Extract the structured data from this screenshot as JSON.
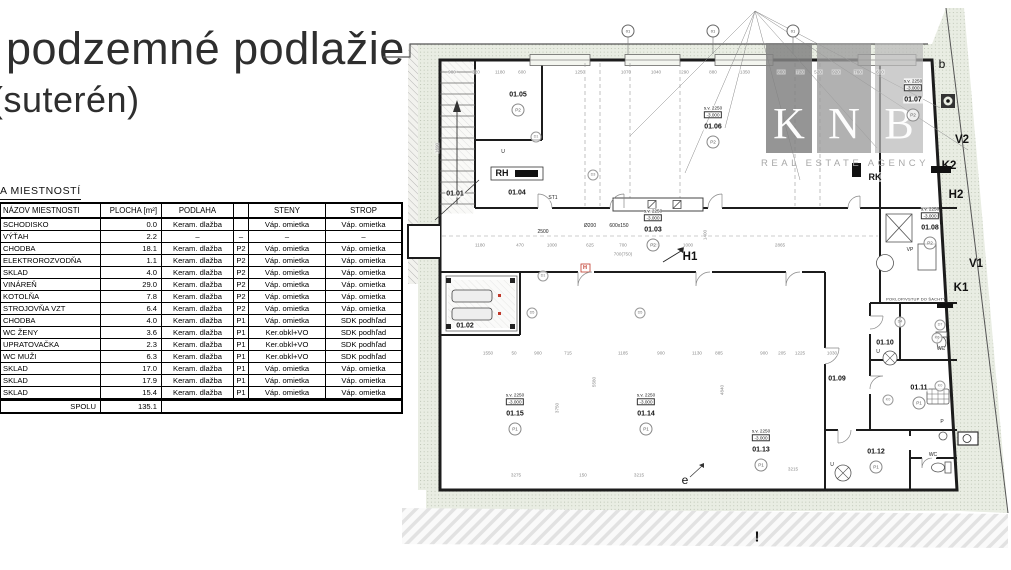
{
  "title": {
    "line1": "podzemné podlažie",
    "line2": "(suterén)"
  },
  "legend": {
    "heading": "A MIESTNOSTÍ",
    "columns": [
      "NÁZOV MIESTNOSTI",
      "PLOCHA [m²]",
      "PODLAHA",
      "",
      "STENY",
      "STROP"
    ],
    "rows": [
      [
        "SCHODISKO",
        "0.0",
        "Keram. dlažba",
        "",
        "Váp. omietka",
        "Váp. omietka"
      ],
      [
        "VÝŤAH",
        "2.2",
        "–",
        "–",
        "–",
        "–"
      ],
      [
        "CHODBA",
        "18.1",
        "Keram. dlažba",
        "P2",
        "Váp. omietka",
        "Váp. omietka"
      ],
      [
        "ELEKTROROZVODŇA",
        "1.1",
        "Keram. dlažba",
        "P2",
        "Váp. omietka",
        "Váp. omietka"
      ],
      [
        "SKLAD",
        "4.0",
        "Keram. dlažba",
        "P2",
        "Váp. omietka",
        "Váp. omietka"
      ],
      [
        "VINÁREŇ",
        "29.0",
        "Keram. dlažba",
        "P2",
        "Váp. omietka",
        "Váp. omietka"
      ],
      [
        "KOTOLŇA",
        "7.8",
        "Keram. dlažba",
        "P2",
        "Váp. omietka",
        "Váp. omietka"
      ],
      [
        "STROJOVŇA VZT",
        "6.4",
        "Keram. dlažba",
        "P2",
        "Váp. omietka",
        "Váp. omietka"
      ],
      [
        "CHODBA",
        "4.0",
        "Keram. dlažba",
        "P1",
        "Váp. omietka",
        "SDK podhľad"
      ],
      [
        "WC ŽENY",
        "3.6",
        "Keram. dlažba",
        "P1",
        "Ker.obkl+VO",
        "SDK podhľad"
      ],
      [
        "UPRATOVAČKA",
        "2.3",
        "Keram. dlažba",
        "P1",
        "Ker.obkl+VO",
        "SDK podhľad"
      ],
      [
        "WC MUŽI",
        "6.3",
        "Keram. dlažba",
        "P1",
        "Ker.obkl+VO",
        "SDK podhľad"
      ],
      [
        "SKLAD",
        "17.0",
        "Keram. dlažba",
        "P1",
        "Váp. omietka",
        "Váp. omietka"
      ],
      [
        "SKLAD",
        "17.9",
        "Keram. dlažba",
        "P1",
        "Váp. omietka",
        "Váp. omietka"
      ],
      [
        "SKLAD",
        "15.4",
        "Keram. dlažba",
        "P1",
        "Váp. omietka",
        "Váp. omietka"
      ]
    ],
    "total_label": "SPOLU",
    "total_value": "135.1"
  },
  "watermark": {
    "letters": [
      "K",
      "N",
      "B"
    ],
    "subtitle": "REAL ESTATE AGENCY",
    "colors": [
      "#828282",
      "#9e9e9e",
      "#bababa"
    ]
  },
  "colors": {
    "accent_red": "#c0392b",
    "site_band": "#e9ede3",
    "wall": "#1c1c1c"
  },
  "plan": {
    "elevation": {
      "height": "s.v. 2250",
      "level": "-3.000"
    },
    "rooms": [
      {
        "id": "01.01",
        "x": 75,
        "y": 186,
        "elev": false,
        "badge": ""
      },
      {
        "id": "01.02",
        "x": 85,
        "y": 318,
        "elev": false,
        "badge": ""
      },
      {
        "id": "01.03",
        "x": 273,
        "y": 222,
        "elev": true,
        "badge": "P2"
      },
      {
        "id": "01.04",
        "x": 137,
        "y": 185,
        "elev": false,
        "badge": ""
      },
      {
        "id": "01.05",
        "x": 138,
        "y": 87,
        "elev": false,
        "badge": "P2"
      },
      {
        "id": "01.06",
        "x": 333,
        "y": 119,
        "elev": true,
        "badge": "P2"
      },
      {
        "id": "01.07",
        "x": 533,
        "y": 92,
        "elev": true,
        "badge": "P2"
      },
      {
        "id": "01.08",
        "x": 550,
        "y": 220,
        "elev": true,
        "badge": "P2"
      },
      {
        "id": "01.09",
        "x": 457,
        "y": 371,
        "elev": false,
        "badge": ""
      },
      {
        "id": "01.10",
        "x": 505,
        "y": 335,
        "elev": false,
        "badge": ""
      },
      {
        "id": "01.11",
        "x": 539,
        "y": 380,
        "elev": false,
        "badge": "P1"
      },
      {
        "id": "01.12",
        "x": 496,
        "y": 444,
        "elev": false,
        "badge": "P1"
      },
      {
        "id": "01.13",
        "x": 381,
        "y": 442,
        "elev": true,
        "badge": "P1"
      },
      {
        "id": "01.14",
        "x": 266,
        "y": 406,
        "elev": true,
        "badge": "P1"
      },
      {
        "id": "01.15",
        "x": 135,
        "y": 406,
        "elev": true,
        "badge": "P1"
      }
    ],
    "markers": [
      {
        "t": "H1",
        "x": 310,
        "y": 249,
        "c": "lg"
      },
      {
        "t": "H2",
        "x": 576,
        "y": 187,
        "c": "lg"
      },
      {
        "t": "K2",
        "x": 569,
        "y": 158,
        "c": "lg"
      },
      {
        "t": "V2",
        "x": 582,
        "y": 132,
        "c": "lg"
      },
      {
        "t": "V1",
        "x": 596,
        "y": 256,
        "c": "lg"
      },
      {
        "t": "K1",
        "x": 581,
        "y": 280,
        "c": "lg"
      },
      {
        "t": "b",
        "x": 562,
        "y": 56,
        "c": "plain"
      },
      {
        "t": "e",
        "x": 305,
        "y": 472,
        "c": "plain"
      },
      {
        "t": "!",
        "x": 377,
        "y": 529,
        "c": "excl"
      },
      {
        "t": "RK",
        "x": 495,
        "y": 169,
        "c": "md"
      },
      {
        "t": "RH",
        "x": 122,
        "y": 165,
        "c": "md"
      },
      {
        "t": "WC",
        "x": 561,
        "y": 341,
        "c": "tiny"
      },
      {
        "t": "WC",
        "x": 553,
        "y": 447,
        "c": "tiny"
      },
      {
        "t": "P",
        "x": 562,
        "y": 414,
        "c": "tiny"
      },
      {
        "t": "U",
        "x": 498,
        "y": 344,
        "c": "tiny"
      },
      {
        "t": "U",
        "x": 452,
        "y": 457,
        "c": "tiny"
      },
      {
        "t": "U",
        "x": 123,
        "y": 144,
        "c": "tiny"
      },
      {
        "t": "VP",
        "x": 530,
        "y": 242,
        "c": "tiny"
      },
      {
        "t": "ST1",
        "x": 173,
        "y": 190,
        "c": "tiny"
      },
      {
        "t": "Ø200",
        "x": 210,
        "y": 218,
        "c": "tiny"
      },
      {
        "t": "600x150",
        "x": 239,
        "y": 218,
        "c": "tiny"
      },
      {
        "t": "2500",
        "x": 163,
        "y": 224,
        "c": "tiny"
      },
      {
        "t": "H",
        "x": 205,
        "y": 260,
        "c": "red"
      },
      {
        "t": "POKLOP/VSTUP DO ŠACHTY",
        "x": 536,
        "y": 291,
        "c": "micro"
      }
    ],
    "grid_markers": [
      {
        "label": "01",
        "x": 248,
        "y": 23
      },
      {
        "label": "01",
        "x": 333,
        "y": 23
      },
      {
        "label": "01",
        "x": 413,
        "y": 23
      }
    ],
    "tags": [
      {
        "t": "D1",
        "x": 156,
        "y": 129
      },
      {
        "t": "D1",
        "x": 163,
        "y": 268
      },
      {
        "t": "D3",
        "x": 213,
        "y": 167
      },
      {
        "t": "D5",
        "x": 152,
        "y": 305
      },
      {
        "t": "D5",
        "x": 260,
        "y": 305
      },
      {
        "t": "D4",
        "x": 520,
        "y": 314
      },
      {
        "t": "D7",
        "x": 560,
        "y": 317
      },
      {
        "t": "K6",
        "x": 557,
        "y": 330
      },
      {
        "t": "K0",
        "x": 560,
        "y": 378
      },
      {
        "t": "K0",
        "x": 508,
        "y": 392
      }
    ],
    "dims": [
      {
        "t": "980",
        "x": 72,
        "y": 64
      },
      {
        "t": "320",
        "x": 96,
        "y": 64
      },
      {
        "t": "1180",
        "x": 120,
        "y": 64
      },
      {
        "t": "600",
        "x": 142,
        "y": 64
      },
      {
        "t": "1250",
        "x": 200,
        "y": 64
      },
      {
        "t": "1070",
        "x": 246,
        "y": 64
      },
      {
        "t": "1040",
        "x": 276,
        "y": 64
      },
      {
        "t": "290",
        "x": 305,
        "y": 64
      },
      {
        "t": "880",
        "x": 333,
        "y": 64
      },
      {
        "t": "1350",
        "x": 365,
        "y": 64
      },
      {
        "t": "860",
        "x": 401,
        "y": 64
      },
      {
        "t": "720",
        "x": 420,
        "y": 64
      },
      {
        "t": "520",
        "x": 438,
        "y": 64
      },
      {
        "t": "920",
        "x": 456,
        "y": 64
      },
      {
        "t": "760",
        "x": 478,
        "y": 64
      },
      {
        "t": "610",
        "x": 500,
        "y": 64
      },
      {
        "t": "1180",
        "x": 100,
        "y": 237
      },
      {
        "t": "470",
        "x": 140,
        "y": 237
      },
      {
        "t": "1000",
        "x": 172,
        "y": 237
      },
      {
        "t": "625",
        "x": 210,
        "y": 237
      },
      {
        "t": "700",
        "x": 243,
        "y": 237
      },
      {
        "t": "625",
        "x": 276,
        "y": 237
      },
      {
        "t": "1000",
        "x": 308,
        "y": 237
      },
      {
        "t": "2865",
        "x": 400,
        "y": 237
      },
      {
        "t": "700(750)",
        "x": 243,
        "y": 246
      },
      {
        "t": "1550",
        "x": 108,
        "y": 345
      },
      {
        "t": "50",
        "x": 134,
        "y": 345
      },
      {
        "t": "900",
        "x": 158,
        "y": 345
      },
      {
        "t": "715",
        "x": 188,
        "y": 345
      },
      {
        "t": "1185",
        "x": 243,
        "y": 345
      },
      {
        "t": "900",
        "x": 281,
        "y": 345
      },
      {
        "t": "1130",
        "x": 317,
        "y": 345
      },
      {
        "t": "885",
        "x": 339,
        "y": 345
      },
      {
        "t": "900",
        "x": 384,
        "y": 345
      },
      {
        "t": "205",
        "x": 402,
        "y": 345
      },
      {
        "t": "1225",
        "x": 420,
        "y": 345
      },
      {
        "t": "1030",
        "x": 452,
        "y": 345
      },
      {
        "t": "3275",
        "x": 136,
        "y": 467
      },
      {
        "t": "150",
        "x": 203,
        "y": 467
      },
      {
        "t": "3215",
        "x": 259,
        "y": 467
      },
      {
        "t": "3215",
        "x": 413,
        "y": 461
      },
      {
        "t": "1690",
        "x": 57,
        "y": 140,
        "r": 1
      },
      {
        "t": "3750",
        "x": 177,
        "y": 400,
        "r": 1
      },
      {
        "t": "5580",
        "x": 214,
        "y": 374,
        "r": 1
      },
      {
        "t": "4840",
        "x": 342,
        "y": 382,
        "r": 1
      },
      {
        "t": "1400",
        "x": 325,
        "y": 227,
        "r": 1
      }
    ]
  }
}
